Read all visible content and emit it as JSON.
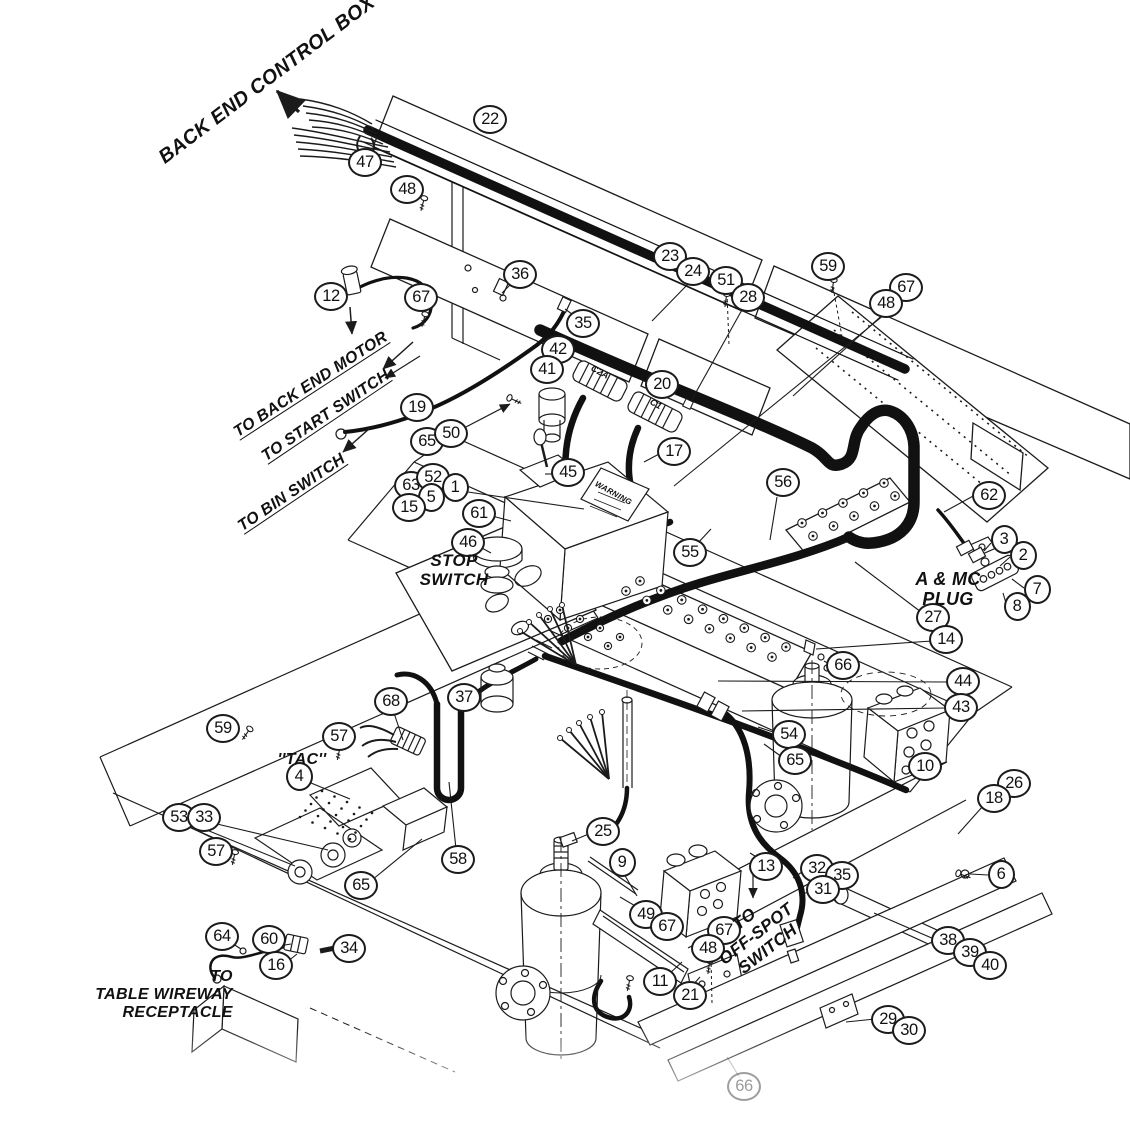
{
  "figure": {
    "type": "exploded-parts-wiring-diagram",
    "background_color": "#ffffff",
    "line_color": "#1b1b1b"
  },
  "labels": [
    {
      "id": "back-end-control-box",
      "text": "BACK END CONTROL BOX",
      "x": 267,
      "y": 80,
      "rotate": -37,
      "size": 20,
      "align": "center"
    },
    {
      "id": "to-back-end-motor",
      "text": "TO BACK END MOTOR",
      "x": 311,
      "y": 385,
      "rotate": -33,
      "size": 16,
      "underline": true
    },
    {
      "id": "to-start-switch",
      "text": "TO START SWITCH",
      "x": 326,
      "y": 416,
      "rotate": -34,
      "size": 16,
      "underline": true
    },
    {
      "id": "to-bin-switch",
      "text": "TO BIN SWITCH",
      "x": 292,
      "y": 493,
      "rotate": -34,
      "size": 16,
      "underline": true
    },
    {
      "id": "stop-switch",
      "lines": [
        "STOP",
        "SWITCH"
      ],
      "x": 454,
      "y": 570,
      "rotate": 0,
      "size": 17,
      "align": "center"
    },
    {
      "id": "a-and-mc-plug",
      "lines": [
        "A & MC",
        "PLUG"
      ],
      "x": 948,
      "y": 589,
      "rotate": 0,
      "size": 18,
      "align": "center"
    },
    {
      "id": "tac",
      "text": "''TAC''",
      "x": 302,
      "y": 760,
      "rotate": 0,
      "size": 16,
      "align": "center"
    },
    {
      "id": "to-off-spot-switch",
      "lines": [
        "TO",
        "OFF-SPOT",
        "SWITCH"
      ],
      "x": 756,
      "y": 934,
      "rotate": -38,
      "size": 17,
      "align": "center"
    },
    {
      "id": "to-table-wireway-receptacle",
      "lines": [
        "TO",
        "TABLE WIREWAY",
        "RECEPTACLE"
      ],
      "x": 164,
      "y": 995,
      "rotate": 0,
      "size": 16,
      "align": "right"
    },
    {
      "id": "warning-label",
      "text": "WARNING",
      "x": 613,
      "y": 494,
      "rotate": 29,
      "size": 8
    },
    {
      "id": "connector-c2a",
      "text": "C2A",
      "x": 600,
      "y": 372,
      "rotate": 28,
      "size": 9
    },
    {
      "id": "connector-c1",
      "text": "C1",
      "x": 656,
      "y": 404,
      "rotate": 28,
      "size": 9
    }
  ],
  "callouts": [
    {
      "n": "22",
      "x": 490,
      "y": 120
    },
    {
      "n": "47",
      "x": 365,
      "y": 163
    },
    {
      "n": "48",
      "x": 407,
      "y": 190
    },
    {
      "n": "12",
      "x": 331,
      "y": 297
    },
    {
      "n": "67",
      "x": 421,
      "y": 298
    },
    {
      "n": "36",
      "x": 520,
      "y": 275
    },
    {
      "n": "23",
      "x": 670,
      "y": 257
    },
    {
      "n": "24",
      "x": 693,
      "y": 272
    },
    {
      "n": "51",
      "x": 726,
      "y": 281
    },
    {
      "n": "28",
      "x": 748,
      "y": 298
    },
    {
      "n": "59",
      "x": 828,
      "y": 267
    },
    {
      "n": "67",
      "x": 906,
      "y": 288
    },
    {
      "n": "48",
      "x": 886,
      "y": 304
    },
    {
      "n": "35",
      "x": 583,
      "y": 324
    },
    {
      "n": "42",
      "x": 558,
      "y": 350
    },
    {
      "n": "41",
      "x": 547,
      "y": 370
    },
    {
      "n": "19",
      "x": 417,
      "y": 408
    },
    {
      "n": "65",
      "x": 427,
      "y": 442
    },
    {
      "n": "50",
      "x": 451,
      "y": 434
    },
    {
      "n": "20",
      "x": 662,
      "y": 385
    },
    {
      "n": "17",
      "x": 674,
      "y": 452
    },
    {
      "n": "45",
      "x": 568,
      "y": 473
    },
    {
      "n": "63",
      "x": 411,
      "y": 486
    },
    {
      "n": "52",
      "x": 433,
      "y": 478
    },
    {
      "n": "5",
      "x": 431,
      "y": 498
    },
    {
      "n": "1",
      "x": 455,
      "y": 488
    },
    {
      "n": "15",
      "x": 409,
      "y": 508
    },
    {
      "n": "61",
      "x": 479,
      "y": 514
    },
    {
      "n": "46",
      "x": 468,
      "y": 543
    },
    {
      "n": "55",
      "x": 690,
      "y": 553
    },
    {
      "n": "56",
      "x": 783,
      "y": 483
    },
    {
      "n": "62",
      "x": 989,
      "y": 496
    },
    {
      "n": "3",
      "x": 1004,
      "y": 540
    },
    {
      "n": "2",
      "x": 1023,
      "y": 556
    },
    {
      "n": "7",
      "x": 1037,
      "y": 590
    },
    {
      "n": "8",
      "x": 1017,
      "y": 607
    },
    {
      "n": "27",
      "x": 933,
      "y": 618
    },
    {
      "n": "14",
      "x": 946,
      "y": 640
    },
    {
      "n": "66",
      "x": 843,
      "y": 666
    },
    {
      "n": "44",
      "x": 963,
      "y": 682
    },
    {
      "n": "43",
      "x": 961,
      "y": 708
    },
    {
      "n": "54",
      "x": 789,
      "y": 735
    },
    {
      "n": "65",
      "x": 795,
      "y": 761
    },
    {
      "n": "10",
      "x": 925,
      "y": 767
    },
    {
      "n": "26",
      "x": 1014,
      "y": 784
    },
    {
      "n": "18",
      "x": 994,
      "y": 799
    },
    {
      "n": "59",
      "x": 223,
      "y": 729
    },
    {
      "n": "57",
      "x": 339,
      "y": 737
    },
    {
      "n": "4",
      "x": 299,
      "y": 777
    },
    {
      "n": "68",
      "x": 391,
      "y": 702
    },
    {
      "n": "37",
      "x": 464,
      "y": 698
    },
    {
      "n": "53",
      "x": 179,
      "y": 818
    },
    {
      "n": "33",
      "x": 204,
      "y": 818
    },
    {
      "n": "57",
      "x": 216,
      "y": 852
    },
    {
      "n": "65",
      "x": 361,
      "y": 886
    },
    {
      "n": "58",
      "x": 458,
      "y": 860
    },
    {
      "n": "25",
      "x": 603,
      "y": 832
    },
    {
      "n": "9",
      "x": 622,
      "y": 863
    },
    {
      "n": "13",
      "x": 766,
      "y": 867
    },
    {
      "n": "32",
      "x": 817,
      "y": 869
    },
    {
      "n": "35",
      "x": 842,
      "y": 876
    },
    {
      "n": "31",
      "x": 823,
      "y": 890
    },
    {
      "n": "6",
      "x": 1001,
      "y": 875
    },
    {
      "n": "38",
      "x": 948,
      "y": 941
    },
    {
      "n": "39",
      "x": 970,
      "y": 953
    },
    {
      "n": "40",
      "x": 990,
      "y": 966
    },
    {
      "n": "29",
      "x": 888,
      "y": 1020
    },
    {
      "n": "30",
      "x": 909,
      "y": 1031
    },
    {
      "n": "49",
      "x": 646,
      "y": 915
    },
    {
      "n": "67",
      "x": 667,
      "y": 927
    },
    {
      "n": "67",
      "x": 724,
      "y": 931
    },
    {
      "n": "48",
      "x": 708,
      "y": 949
    },
    {
      "n": "11",
      "x": 660,
      "y": 982
    },
    {
      "n": "21",
      "x": 690,
      "y": 996
    },
    {
      "n": "64",
      "x": 222,
      "y": 937
    },
    {
      "n": "60",
      "x": 269,
      "y": 940
    },
    {
      "n": "16",
      "x": 276,
      "y": 966
    },
    {
      "n": "34",
      "x": 349,
      "y": 949
    },
    {
      "n": "66",
      "x": 744,
      "y": 1087,
      "faded": true
    }
  ]
}
